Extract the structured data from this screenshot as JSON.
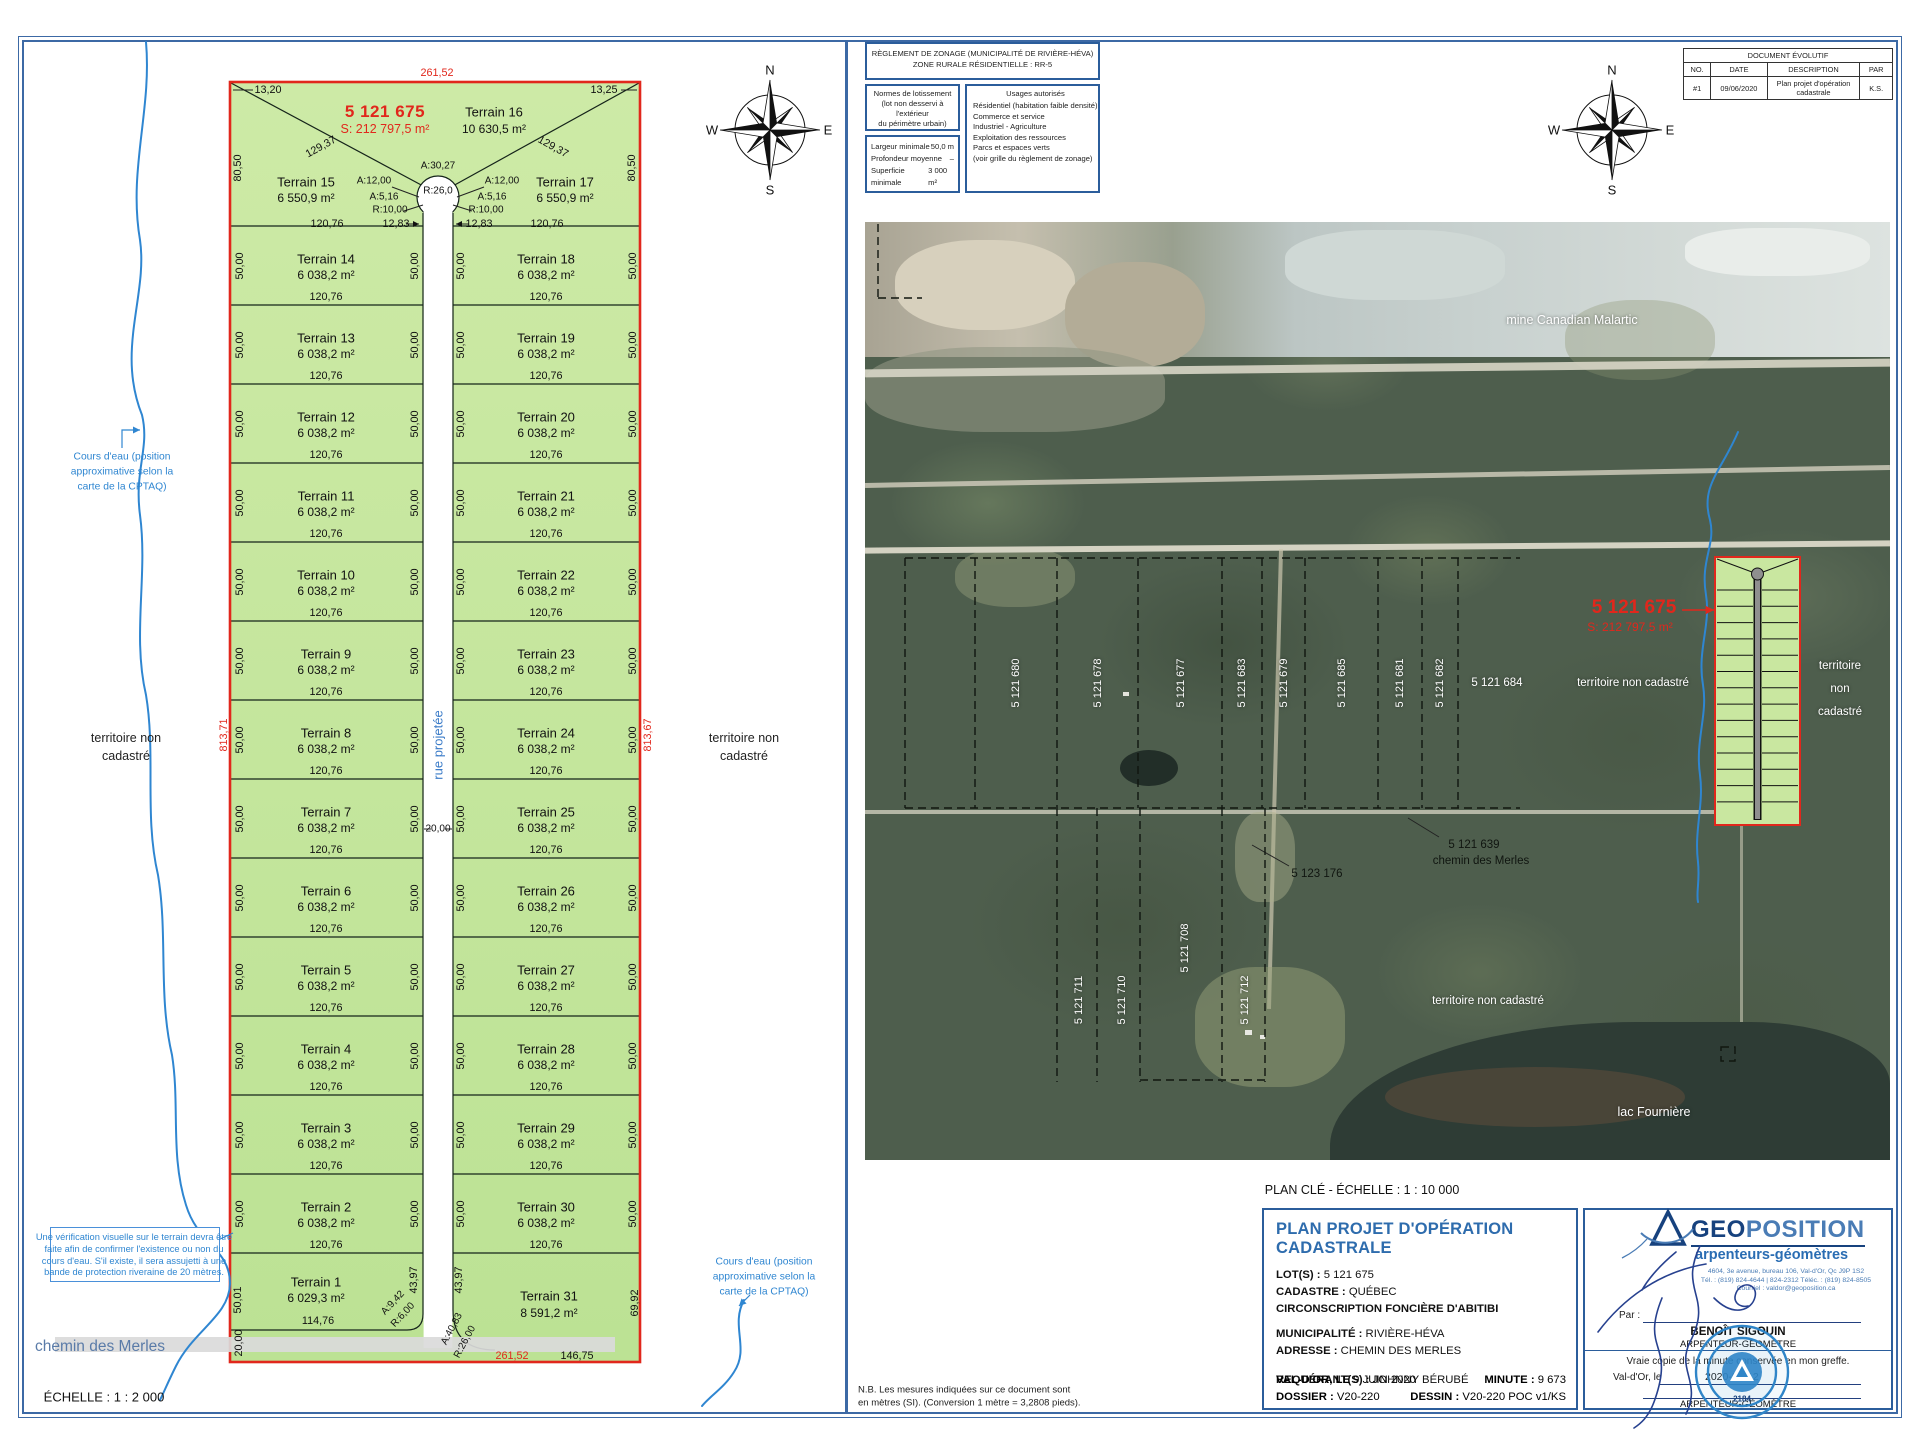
{
  "sheet": {
    "scale_label": "ÉCHELLE : 1 : 2 000",
    "plan_cle_label": "PLAN CLÉ - ÉCHELLE : 1 : 10 000",
    "nb_line1": "N.B. Les mesures indiquées sur ce document sont",
    "nb_line2": "en mètres (SI). (Conversion 1 mètre = 3,2808 pieds).",
    "compass": {
      "n": "N",
      "e": "E",
      "s": "S",
      "w": "W"
    }
  },
  "zoning": {
    "title1": "RÈGLEMENT DE ZONAGE (MUNICIPALITÉ DE RIVIÈRE-HÉVA)",
    "title2": "ZONE RURALE RÉSIDENTIELLE : RR-5",
    "normes_title": "Normes de lotissement",
    "normes_sub1": "(lot non desservi à l'extérieur",
    "normes_sub2": "du périmètre urbain)",
    "rows": [
      {
        "label": "Largeur minimale",
        "value": "50,0 m"
      },
      {
        "label": "Profondeur moyenne",
        "value": "–"
      },
      {
        "label": "Superficie minimale",
        "value": "3 000 m²"
      }
    ],
    "usages_title": "Usages autorisés",
    "usages": [
      "Résidentiel (habitation faible densité)",
      "Commerce et service",
      "Industriel - Agriculture",
      "Exploitation des ressources",
      "Parcs et espaces verts",
      "(voir grille du règlement de zonage)"
    ]
  },
  "doc_table": {
    "title": "DOCUMENT ÉVOLUTIF",
    "headers": [
      "NO.",
      "DATE",
      "DESCRIPTION",
      "PAR"
    ],
    "row": [
      "#1",
      "09/06/2020",
      "Plan projet d'opération cadastrale",
      "K.S."
    ]
  },
  "plan": {
    "rows_left": [
      "Terrain 14",
      "Terrain 13",
      "Terrain 12",
      "Terrain 11",
      "Terrain 10",
      "Terrain 9",
      "Terrain 8",
      "Terrain 7",
      "Terrain 6",
      "Terrain 5",
      "Terrain 4",
      "Terrain 3",
      "Terrain 2"
    ],
    "rows_right": [
      "Terrain 18",
      "Terrain 19",
      "Terrain 20",
      "Terrain 21",
      "Terrain 22",
      "Terrain 23",
      "Terrain 24",
      "Terrain 25",
      "Terrain 26",
      "Terrain 27",
      "Terrain 28",
      "Terrain 29",
      "Terrain 30"
    ],
    "row_area": "6 038,2 m²",
    "row_width": "120,76",
    "row_side": "50,00",
    "long_left": "813,71",
    "long_right": "813,67"
  },
  "titleblock": {
    "title": "PLAN PROJET D'OPÉRATION CADASTRALE",
    "lot_label": "LOT(S) :",
    "lot_value": "5 121 675",
    "cad_label": "CADASTRE :",
    "cad_value": "QUÉBEC",
    "circ": "CIRCONSCRIPTION FONCIÈRE D'ABITIBI",
    "mun_label": "MUNICIPALITÉ :",
    "mun_value": "RIVIÈRE-HÉVA",
    "adr_label": "ADRESSE :",
    "adr_value": "CHEMIN DES MERLES",
    "req_label": "REQUÉRANT(S) :",
    "req_value": "JOHNNY BÉRUBÉ",
    "city_label": "VAL-D'OR, LE",
    "city_value": "9 JUIN 2020",
    "minute_label": "MINUTE :",
    "minute_value": "9 673",
    "dossier_label": "DOSSIER :",
    "dossier_value": "V20-220",
    "dessin_label": "DESSIN :",
    "dessin_value": "V20-220 POC v1/KS"
  },
  "geoposition": {
    "name_geo": "GEO",
    "name_pos": "POSITION",
    "subtitle": "arpenteurs-géomètres",
    "address": "4604, 3e avenue, bureau 106, Val-d'Or, Qc J9P 1S2",
    "phone": "Tél. : (819) 824-4644 | 824-2312   Téléc. : (819) 824-8505",
    "email": "Courriel : valdor@geoposition.ca",
    "par_label": "Par :",
    "surveyor": "BENOÎT SIGOUIN",
    "surveyor_title": "ARPENTEUR-GÉOMÈTRE",
    "certify": "Vraie copie de la minute conservée en mon greffe.",
    "place_label": "Val-d'Or, le",
    "stamp_date": "2020-06-12",
    "bottom_title": "ARPENTEUR-GÉOMÈTRE",
    "stamp_number": "2184"
  },
  "labels": [
    {
      "t": "13,20",
      "x": 268,
      "y": 90,
      "cls": "dim",
      "n": "dim-13-20"
    },
    {
      "t": "261,52",
      "x": 437,
      "y": 73,
      "cls": "dim red",
      "n": "dim-261-52-top"
    },
    {
      "t": "13,25",
      "x": 604,
      "y": 90,
      "cls": "dim",
      "n": "dim-13-25"
    },
    {
      "t": "5 121 675",
      "x": 385,
      "y": 112,
      "cls": "lotnum",
      "n": "lot-number"
    },
    {
      "t": "S: 212 797,5 m²",
      "x": 385,
      "y": 129,
      "cls": "lotarea",
      "n": "lot-area"
    },
    {
      "t": "Terrain 16",
      "x": 494,
      "y": 112,
      "cls": "tn",
      "n": "terrain-16-name"
    },
    {
      "t": "10 630,5 m²",
      "x": 494,
      "y": 129,
      "cls": "ta",
      "n": "terrain-16-area"
    },
    {
      "t": "129,37",
      "x": 321,
      "y": 147,
      "cls": "dim sl",
      "n": "dim-129-37"
    },
    {
      "t": "129,37",
      "x": 553,
      "y": 147,
      "cls": "dim sr",
      "n": "dim-129-37"
    },
    {
      "t": "80,50",
      "x": 238,
      "y": 168,
      "cls": "dim rot",
      "n": "dim-80-50"
    },
    {
      "t": "80,50",
      "x": 632,
      "y": 168,
      "cls": "dim rot",
      "n": "dim-80-50"
    },
    {
      "t": "Terrain 15",
      "x": 306,
      "y": 182,
      "cls": "tn",
      "n": "terrain-15-name"
    },
    {
      "t": "6 550,9 m²",
      "x": 306,
      "y": 198,
      "cls": "ta",
      "n": "terrain-15-area"
    },
    {
      "t": "Terrain 17",
      "x": 565,
      "y": 182,
      "cls": "tn",
      "n": "terrain-17-name"
    },
    {
      "t": "6 550,9 m²",
      "x": 565,
      "y": 198,
      "cls": "ta",
      "n": "terrain-17-area"
    },
    {
      "t": "A:12,00",
      "x": 374,
      "y": 181,
      "cls": "dims"
    },
    {
      "t": "A:12,00",
      "x": 502,
      "y": 181,
      "cls": "dims"
    },
    {
      "t": "A:5,16",
      "x": 384,
      "y": 197,
      "cls": "dims"
    },
    {
      "t": "A:5,16",
      "x": 492,
      "y": 197,
      "cls": "dims"
    },
    {
      "t": "R:10,00",
      "x": 390,
      "y": 210,
      "cls": "dims"
    },
    {
      "t": "R:10,00",
      "x": 486,
      "y": 210,
      "cls": "dims"
    },
    {
      "t": "A:30,27",
      "x": 438,
      "y": 166,
      "cls": "dims",
      "n": "dim-a-30-27"
    },
    {
      "t": "R:26,0",
      "x": 438,
      "y": 191,
      "cls": "dims",
      "n": "dim-r-26"
    },
    {
      "t": "12,83",
      "x": 396,
      "y": 224,
      "cls": "dim"
    },
    {
      "t": "12,83",
      "x": 479,
      "y": 224,
      "cls": "dim"
    },
    {
      "t": "120,76",
      "x": 327,
      "y": 224,
      "cls": "dim"
    },
    {
      "t": "120,76",
      "x": 547,
      "y": 224,
      "cls": "dim"
    },
    {
      "t": "rue projetée",
      "x": 438,
      "y": 745,
      "cls": "street rot",
      "n": "street-label"
    },
    {
      "t": "20,00",
      "x": 438,
      "y": 829,
      "cls": "dims",
      "n": "street-width"
    },
    {
      "t": "Terrain 1",
      "x": 316,
      "y": 1282,
      "cls": "tn",
      "n": "terrain-1-name"
    },
    {
      "t": "6 029,3 m²",
      "x": 316,
      "y": 1298,
      "cls": "ta",
      "n": "terrain-1-area"
    },
    {
      "t": "114,76",
      "x": 318,
      "y": 1321,
      "cls": "dim"
    },
    {
      "t": "50,01",
      "x": 238,
      "y": 1300,
      "cls": "dim rot"
    },
    {
      "t": "43,97",
      "x": 414,
      "y": 1280,
      "cls": "dim rot"
    },
    {
      "t": "A:9,42",
      "x": 393,
      "y": 1303,
      "cls": "dims r45"
    },
    {
      "t": "R:6,00",
      "x": 403,
      "y": 1315,
      "cls": "dims r45"
    },
    {
      "t": "20,00",
      "x": 239,
      "y": 1343,
      "cls": "dim rot",
      "n": "chemin-width"
    },
    {
      "t": "Terrain 31",
      "x": 549,
      "y": 1296,
      "cls": "tn",
      "n": "terrain-31-name"
    },
    {
      "t": "8 591,2 m²",
      "x": 549,
      "y": 1313,
      "cls": "ta",
      "n": "terrain-31-area"
    },
    {
      "t": "69,92",
      "x": 635,
      "y": 1303,
      "cls": "dim rot"
    },
    {
      "t": "43,97",
      "x": 459,
      "y": 1280,
      "cls": "dim rot"
    },
    {
      "t": "A:40,83",
      "x": 452,
      "y": 1329,
      "cls": "dims r60"
    },
    {
      "t": "R:26,00",
      "x": 465,
      "y": 1342,
      "cls": "dims r60"
    },
    {
      "t": "261,52",
      "x": 512,
      "y": 1356,
      "cls": "dim red",
      "n": "dim-261-52-bottom"
    },
    {
      "t": "146,75",
      "x": 577,
      "y": 1356,
      "cls": "dim"
    },
    {
      "t": "territoire non",
      "x": 126,
      "y": 738,
      "cls": "terr",
      "n": "territoire-left"
    },
    {
      "t": "cadastré",
      "x": 126,
      "y": 756,
      "cls": "terr"
    },
    {
      "t": "territoire non",
      "x": 744,
      "y": 738,
      "cls": "terr",
      "n": "territoire-right"
    },
    {
      "t": "cadastré",
      "x": 744,
      "y": 756,
      "cls": "terr"
    },
    {
      "t": "Cours d'eau (position",
      "x": 122,
      "y": 457,
      "cls": "bnote",
      "n": "cours-eau-note"
    },
    {
      "t": "approximative selon la",
      "x": 122,
      "y": 472,
      "cls": "bnote"
    },
    {
      "t": "carte de la CPTAQ)",
      "x": 122,
      "y": 487,
      "cls": "bnote"
    },
    {
      "t": "Cours d'eau (position",
      "x": 764,
      "y": 1262,
      "cls": "bnote",
      "n": "cours-eau-note"
    },
    {
      "t": "approximative selon la",
      "x": 764,
      "y": 1277,
      "cls": "bnote"
    },
    {
      "t": "carte de la CPTAQ)",
      "x": 764,
      "y": 1292,
      "cls": "bnote"
    },
    {
      "t": "Une vérification visuelle sur le terrain devra être",
      "x": 134,
      "y": 1237,
      "cls": "vnote",
      "n": "verification-note"
    },
    {
      "t": "faite afin de confirmer l'existence ou non du",
      "x": 134,
      "y": 1249,
      "cls": "vnote"
    },
    {
      "t": "cours d'eau. S'il existe, il sera assujetti à une",
      "x": 134,
      "y": 1261,
      "cls": "vnote"
    },
    {
      "t": "bande de protection riveraine de 20 mètres.",
      "x": 134,
      "y": 1272,
      "cls": "vnote"
    },
    {
      "t": "chemin des Merles",
      "x": 100,
      "y": 1347,
      "cls": "chemin",
      "n": "chemin-des-merles-label"
    },
    {
      "t": "ÉCHELLE : 1 : 2 000",
      "x": 104,
      "y": 1397,
      "cls": "echelle",
      "n": "scale-label"
    },
    {
      "t": "N",
      "x": 770,
      "y": 70,
      "cls": "cmp",
      "n": "compass-n"
    },
    {
      "t": "W",
      "x": 712,
      "y": 130,
      "cls": "cmp",
      "n": "compass-w"
    },
    {
      "t": "E",
      "x": 828,
      "y": 130,
      "cls": "cmp",
      "n": "compass-e"
    },
    {
      "t": "S",
      "x": 770,
      "y": 190,
      "cls": "cmp",
      "n": "compass-s"
    },
    {
      "t": "N",
      "x": 1612,
      "y": 70,
      "cls": "cmp",
      "n": "compass-n"
    },
    {
      "t": "W",
      "x": 1554,
      "y": 130,
      "cls": "cmp",
      "n": "compass-w"
    },
    {
      "t": "E",
      "x": 1670,
      "y": 130,
      "cls": "cmp",
      "n": "compass-e"
    },
    {
      "t": "S",
      "x": 1612,
      "y": 190,
      "cls": "cmp",
      "n": "compass-s"
    },
    {
      "t": "mine Canadian Malartic",
      "x": 1572,
      "y": 320,
      "cls": "pw pm",
      "n": "mine-label"
    },
    {
      "t": "5 121 680",
      "x": 1016,
      "y": 683,
      "cls": "pv",
      "n": "photo-lot"
    },
    {
      "t": "5 121 678",
      "x": 1098,
      "y": 683,
      "cls": "pv",
      "n": "photo-lot"
    },
    {
      "t": "5 121 677",
      "x": 1181,
      "y": 683,
      "cls": "pv",
      "n": "photo-lot"
    },
    {
      "t": "5 121 683",
      "x": 1242,
      "y": 683,
      "cls": "pv",
      "n": "photo-lot"
    },
    {
      "t": "5 121 679",
      "x": 1284,
      "y": 683,
      "cls": "pv",
      "n": "photo-lot"
    },
    {
      "t": "5 121 685",
      "x": 1342,
      "y": 683,
      "cls": "pv",
      "n": "photo-lot"
    },
    {
      "t": "5 121 681",
      "x": 1400,
      "y": 683,
      "cls": "pv",
      "n": "photo-lot"
    },
    {
      "t": "5 121 682",
      "x": 1440,
      "y": 683,
      "cls": "pv",
      "n": "photo-lot"
    },
    {
      "t": "5 121 684",
      "x": 1497,
      "y": 683,
      "cls": "pw",
      "n": "photo-lot"
    },
    {
      "t": "territoire non cadastré",
      "x": 1633,
      "y": 683,
      "cls": "pw",
      "n": "territoire-photo-mid"
    },
    {
      "t": "territoire",
      "x": 1840,
      "y": 666,
      "cls": "pw",
      "n": "territoire-photo-right"
    },
    {
      "t": "non",
      "x": 1840,
      "y": 689,
      "cls": "pw"
    },
    {
      "t": "cadastré",
      "x": 1840,
      "y": 712,
      "cls": "pw"
    },
    {
      "t": "5 121 711",
      "x": 1079,
      "y": 1000,
      "cls": "pv",
      "n": "photo-lot"
    },
    {
      "t": "5 121 710",
      "x": 1122,
      "y": 1000,
      "cls": "pv",
      "n": "photo-lot"
    },
    {
      "t": "5 121 708",
      "x": 1185,
      "y": 948,
      "cls": "pv",
      "n": "photo-lot"
    },
    {
      "t": "5 121 712",
      "x": 1245,
      "y": 1000,
      "cls": "pv",
      "n": "photo-lot"
    },
    {
      "t": "territoire non cadastré",
      "x": 1488,
      "y": 1001,
      "cls": "pw",
      "n": "territoire-photo-bottom"
    },
    {
      "t": "lac Fournière",
      "x": 1654,
      "y": 1112,
      "cls": "pw pm",
      "n": "lake-label"
    },
    {
      "t": "5 123 176",
      "x": 1317,
      "y": 874,
      "cls": "pblk",
      "n": "photo-lot"
    },
    {
      "t": "5 121 639",
      "x": 1474,
      "y": 845,
      "cls": "pblk",
      "n": "photo-lot"
    },
    {
      "t": "chemin des Merles",
      "x": 1481,
      "y": 861,
      "cls": "pblk",
      "n": "chemin-photo-label"
    },
    {
      "t": "5 121 675",
      "x": 1634,
      "y": 608,
      "cls": "predbig",
      "n": "photo-lot-number"
    },
    {
      "t": "S: 212 797,5 m²",
      "x": 1630,
      "y": 627,
      "cls": "pred",
      "n": "photo-lot-area"
    },
    {
      "t": "PLAN CLÉ - ÉCHELLE : 1 : 10 000",
      "x": 1362,
      "y": 1190,
      "cls": "pcl",
      "n": "plan-cle-label"
    },
    {
      "t": "N.B. Les mesures indiquées sur ce document sont",
      "x": 858,
      "y": 1390,
      "cls": "nb left",
      "n": "nb-note"
    },
    {
      "t": "en mètres (SI). (Conversion 1 mètre = 3,2808 pieds).",
      "x": 858,
      "y": 1403,
      "cls": "nb left"
    },
    {
      "t": "2184",
      "x": 1742,
      "y": 1399,
      "cls": "stampnum",
      "n": "stamp-number"
    }
  ]
}
